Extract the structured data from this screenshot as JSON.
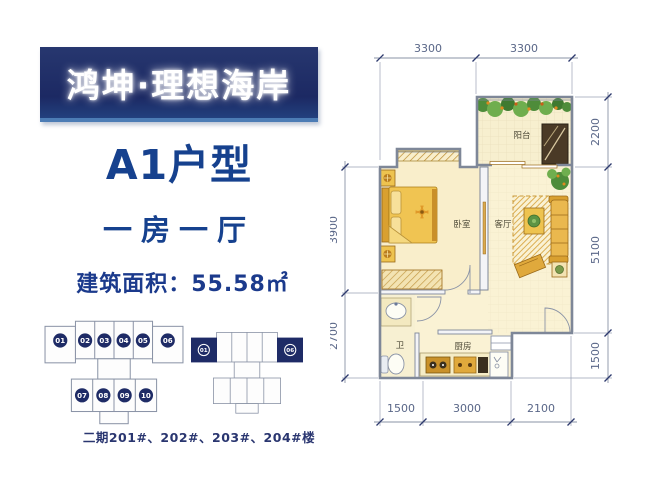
{
  "brand": {
    "name": "鸿坤·理想海岸"
  },
  "unit": {
    "type": "A1户型",
    "rooms": "一房一厅",
    "area": "建筑面积：55.58㎡"
  },
  "note": {
    "buildings": "二期201#、202#、203#、204#楼"
  },
  "site_plan": {
    "building_a": {
      "top_units": [
        "01",
        "02",
        "03",
        "04",
        "05",
        "06"
      ],
      "bottom_units": [
        "07",
        "08",
        "09",
        "10"
      ]
    },
    "building_b": {
      "highlighted_units": [
        "01",
        "06"
      ]
    }
  },
  "floor_plan": {
    "rooms": {
      "balcony": "阳台",
      "bedroom": "卧室",
      "living": "客厅",
      "bath": "卫",
      "kitchen": "厨房"
    },
    "dims": {
      "top": [
        "3300",
        "3300"
      ],
      "right": [
        "2200",
        "5100",
        "1500"
      ],
      "left": [
        "3900",
        "2700"
      ],
      "bottom": [
        "1500",
        "3000",
        "2100"
      ]
    }
  },
  "colors": {
    "banner_navy": "#1e2a66",
    "title_blue": "#16418e",
    "dim_text": "#5a6788",
    "floor_cream": "#faf2d4",
    "furniture_gold": "#eec34f"
  }
}
